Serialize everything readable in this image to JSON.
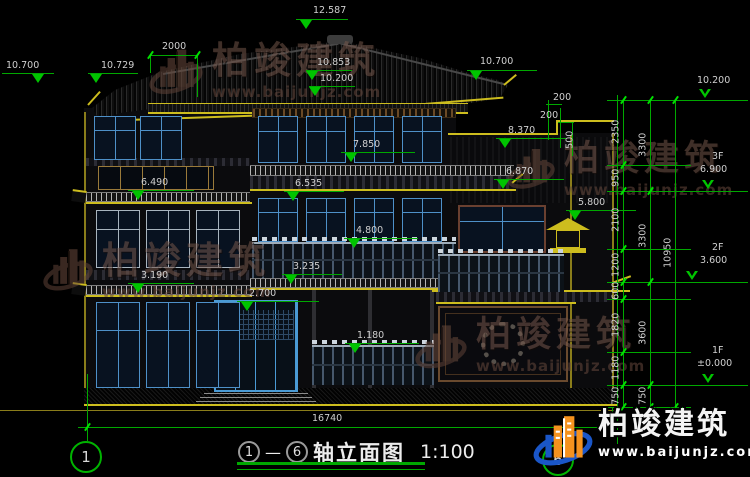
{
  "title_block": {
    "axis_start": "1",
    "dash": "—",
    "axis_end": "6",
    "name": "轴立面图",
    "scale": "1:100"
  },
  "brand": {
    "name": "柏竣建筑",
    "url": "www.baijunjz.com"
  },
  "axis": {
    "left": "1",
    "right": "6"
  },
  "levels": [
    "12.587",
    "10.853",
    "10.200",
    "10.700",
    "10.729",
    "10.700",
    "8.370",
    "7.850",
    "6.535",
    "6.490",
    "6.870",
    "5.800",
    "4.800",
    "3.235",
    "3.190",
    "2.700",
    "1.180"
  ],
  "right_levels": [
    {
      "floor": "",
      "label": "10.200"
    },
    {
      "floor": "3F",
      "label": "6.900"
    },
    {
      "floor": "2F",
      "label": "3.600"
    },
    {
      "floor": "1F",
      "label": "±0.000"
    }
  ],
  "small_dims": {
    "top_left": "2000",
    "s1": "200",
    "s2": "200",
    "s3": "500"
  },
  "bottom_dim": "16740",
  "chain1": [
    "2350",
    "950",
    "2100",
    "1200",
    "600",
    "1820",
    "1180",
    "750"
  ],
  "chain2": [
    "3300",
    "3300",
    "3600",
    "750"
  ],
  "chain_total": "10950",
  "colors": {
    "dim_green": "#00a800",
    "bright_green": "#00e000",
    "outline_yellow": "#cdbd1e",
    "window_blue": "#4e90c8",
    "text_gray": "#cfcfcf",
    "brand_orange": "#f5921e",
    "brand_blue": "#1a56c8"
  }
}
